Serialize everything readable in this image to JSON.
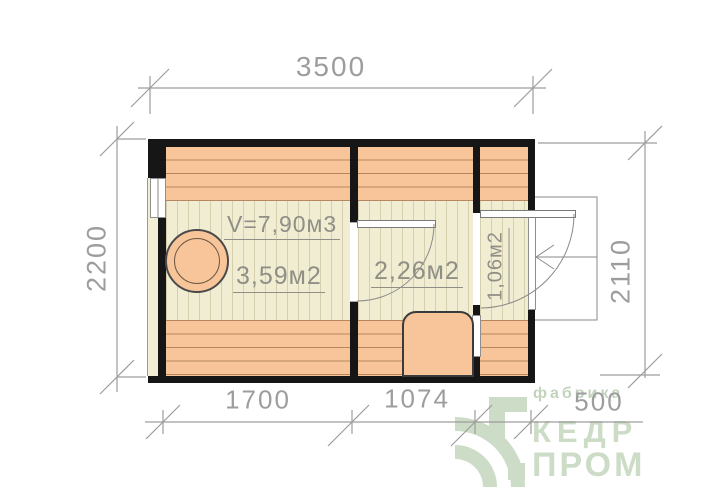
{
  "plan": {
    "dimensions": {
      "top": "3500",
      "left": "2200",
      "right": "2110",
      "bottom_sauna": "1700",
      "bottom_washroom": "1074",
      "bottom_hall": "500"
    },
    "rooms": {
      "sauna_volume": "V=7,90м3",
      "sauna_area": "3,59м2",
      "washroom_area": "2,26м2",
      "hall_area": "1,06м2"
    }
  },
  "logo": {
    "tagline": "фабрика",
    "line1": "КЕДР",
    "line2": "ПРОМ"
  },
  "colors": {
    "wood_fill": "#f8c59a",
    "floor_fill": "#f1edd3",
    "wall": "#161616",
    "dimension_gray": "#9d9d9d",
    "label_gray": "#8f8f85",
    "logo_green": "#ccdcc7"
  }
}
